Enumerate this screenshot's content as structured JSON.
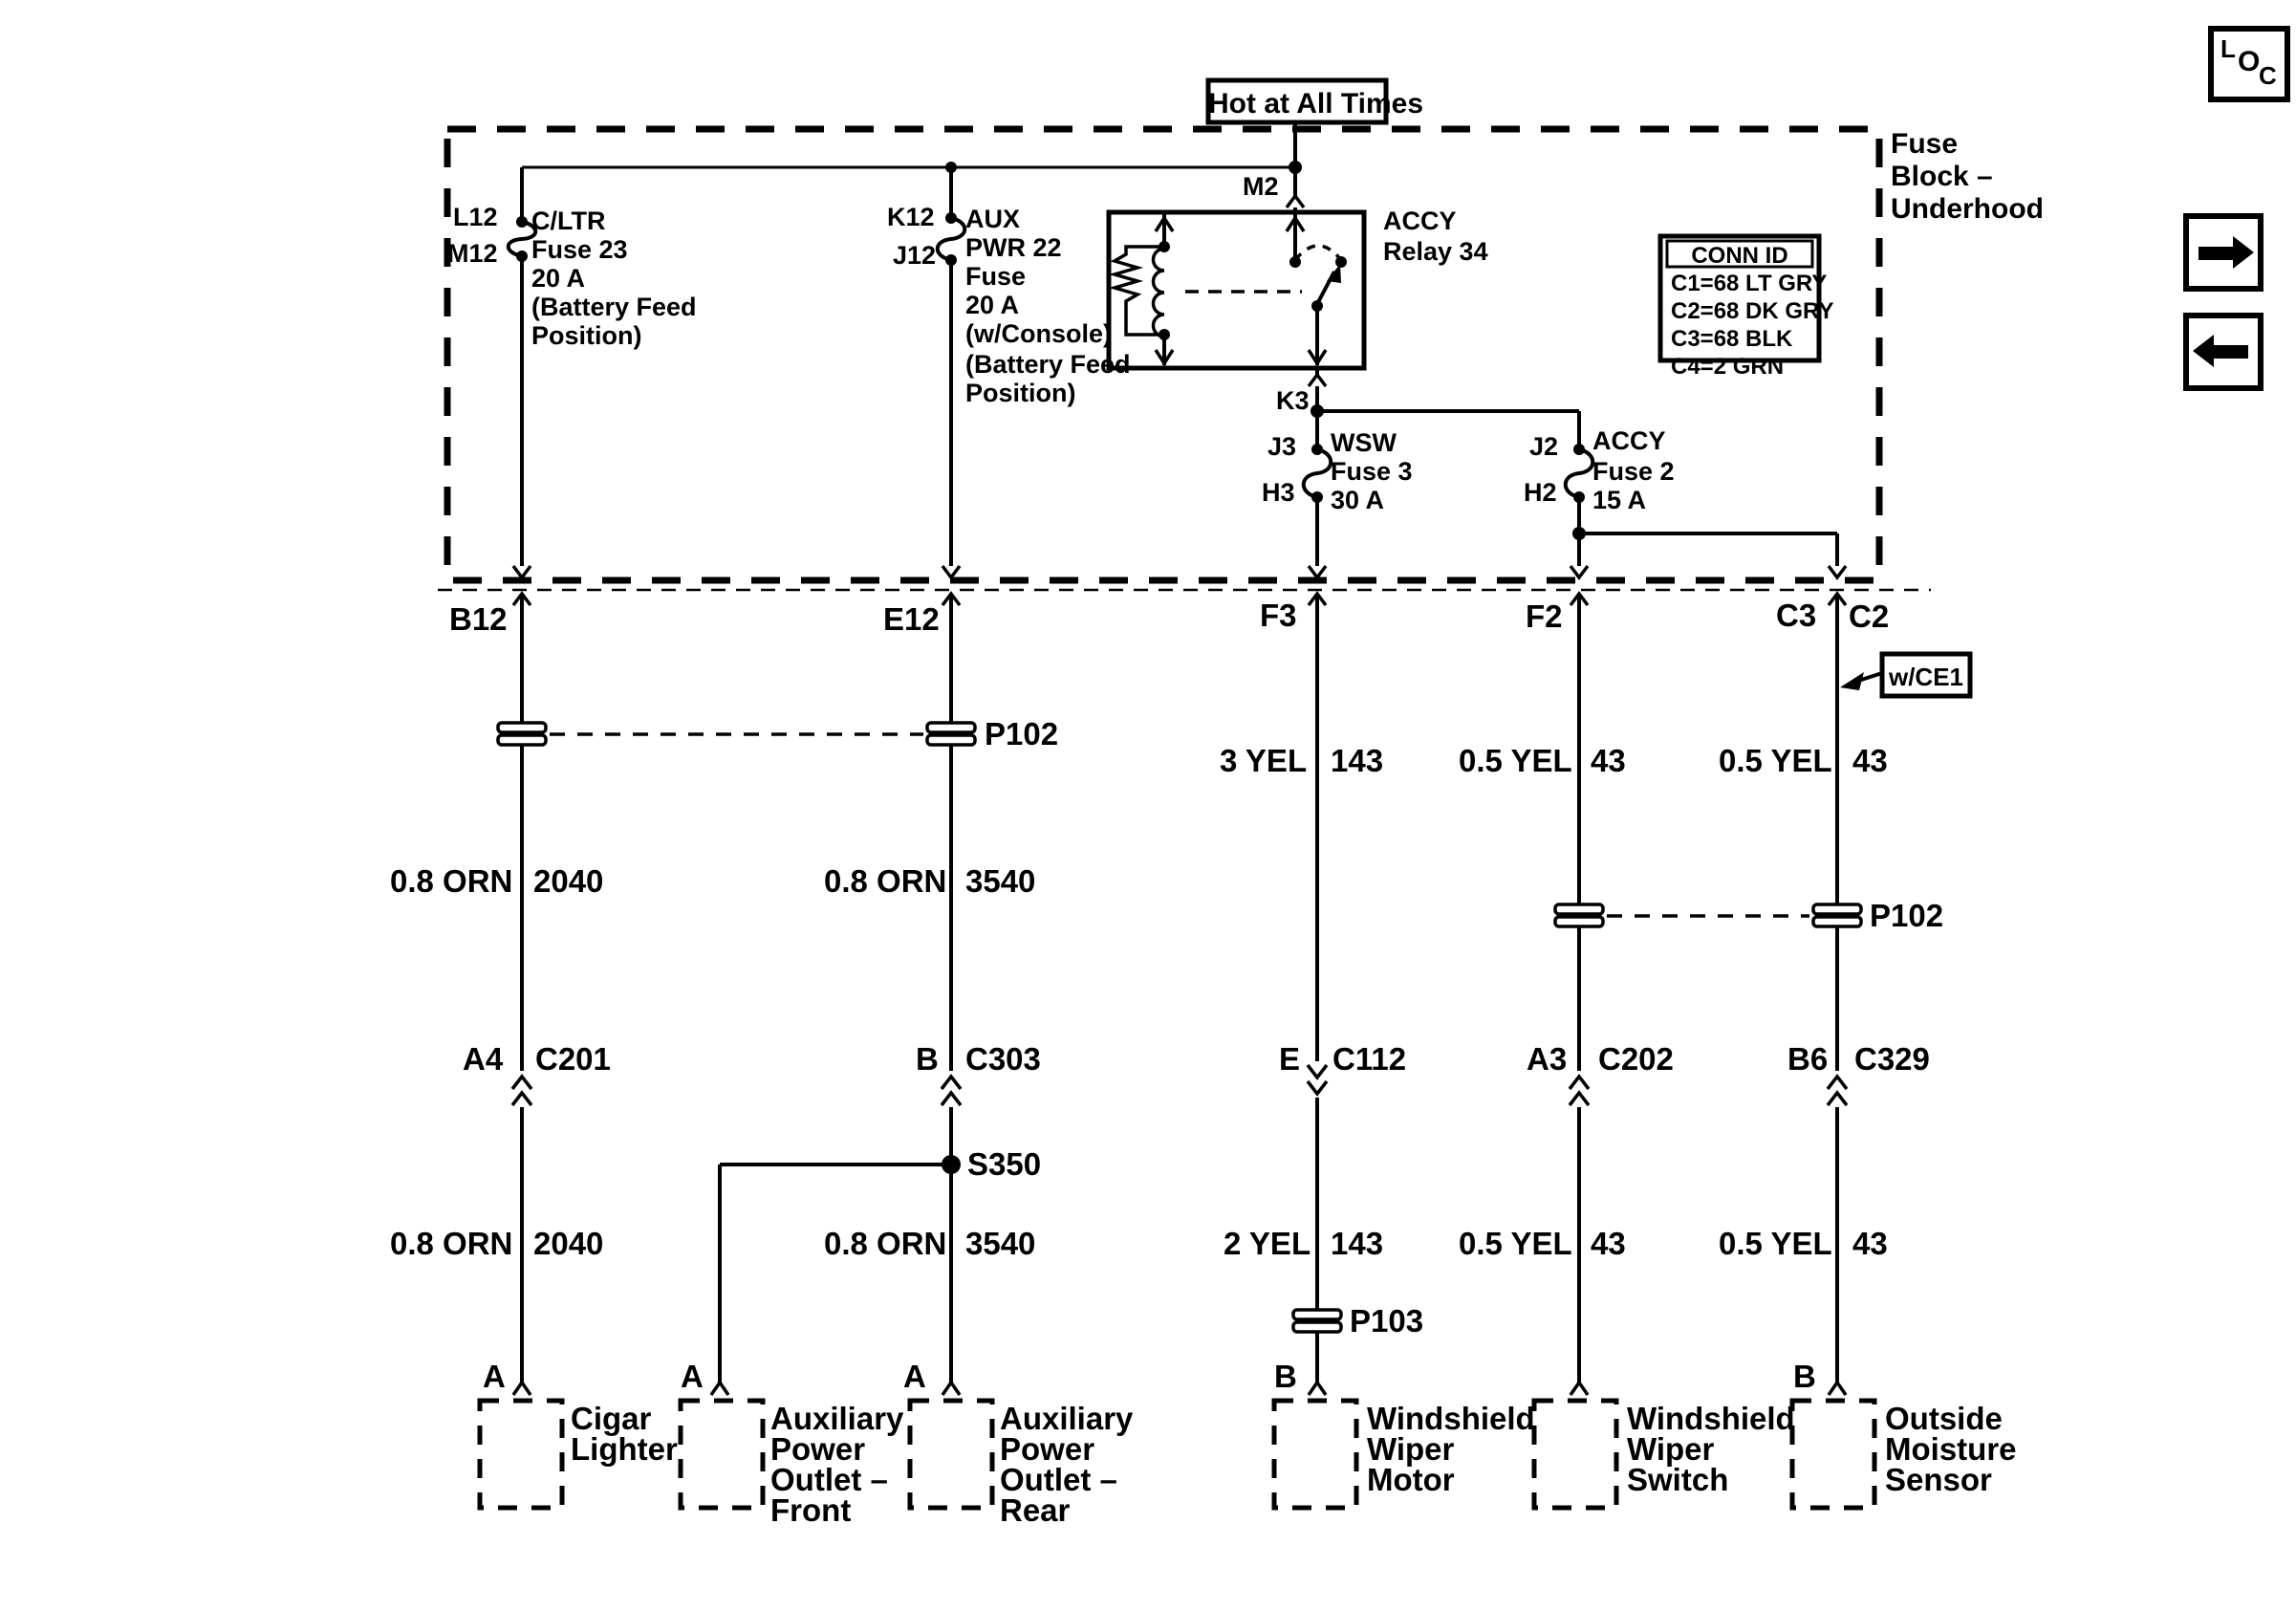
{
  "diagram": {
    "hot_label": "Hot at All Times",
    "block_name": [
      "Fuse",
      "Block –",
      "Underhood"
    ],
    "relay_label": [
      "ACCY",
      "Relay 34"
    ],
    "conn_id": {
      "title": "CONN ID",
      "rows": [
        "C1=68 LT GRY",
        "C2=68 DK GRY",
        "C3=68 BLK",
        "C4=2 GRN"
      ]
    },
    "terminals": {
      "m2": "M2",
      "k3": "K3",
      "l12": "L12",
      "m12": "M12",
      "k12": "K12",
      "j12": "J12",
      "j3": "J3",
      "h3": "H3",
      "j2": "J2",
      "h2": "H2"
    },
    "fuses": {
      "cltr": [
        "C/LTR",
        "Fuse 23",
        "20 A",
        "(Battery Feed",
        "Position)"
      ],
      "aux": [
        "AUX",
        "PWR 22",
        "Fuse",
        "20 A",
        "(w/Console)",
        "(Battery Feed",
        "Position)"
      ],
      "wsw": [
        "WSW",
        "Fuse 3",
        "30 A"
      ],
      "accy": [
        "ACCY",
        "Fuse 2",
        "15 A"
      ]
    },
    "block_exits": [
      "B12",
      "E12",
      "F3",
      "F2",
      "C3",
      "C2"
    ],
    "note_wce1": "w/CE1",
    "splices": {
      "s350": "S350"
    },
    "pass_throughs": {
      "p102_left": "P102",
      "p102_right": "P102",
      "p103": "P103"
    },
    "inline_connectors": [
      {
        "pin": "A4",
        "name": "C201"
      },
      {
        "pin": "B",
        "name": "C303"
      },
      {
        "pin": "E",
        "name": "C112"
      },
      {
        "pin": "A3",
        "name": "C202"
      },
      {
        "pin": "B6",
        "name": "C329"
      }
    ],
    "wire_labels": [
      {
        "gauge": "3 YEL",
        "circuit": "143"
      },
      {
        "gauge": "0.5 YEL",
        "circuit": "43"
      },
      {
        "gauge": "0.5 YEL",
        "circuit": "43"
      },
      {
        "gauge": "0.8 ORN",
        "circuit": "2040"
      },
      {
        "gauge": "0.8 ORN",
        "circuit": "3540"
      },
      {
        "gauge": "0.8 ORN",
        "circuit": "2040"
      },
      {
        "gauge": "0.8 ORN",
        "circuit": "3540"
      },
      {
        "gauge": "2 YEL",
        "circuit": "143"
      },
      {
        "gauge": "0.5 YEL",
        "circuit": "43"
      },
      {
        "gauge": "0.5 YEL",
        "circuit": "43"
      }
    ],
    "components": [
      {
        "pin": "A",
        "lines": [
          "Cigar",
          "Lighter"
        ]
      },
      {
        "pin": "A",
        "lines": [
          "Auxiliary",
          "Power",
          "Outlet –",
          "Front"
        ]
      },
      {
        "pin": "A",
        "lines": [
          "Auxiliary",
          "Power",
          "Outlet –",
          "Rear"
        ]
      },
      {
        "pin": "B",
        "lines": [
          "Windshield",
          "Wiper",
          "Motor"
        ]
      },
      {
        "pin": "",
        "lines": [
          "Windshield",
          "Wiper",
          "Switch"
        ]
      },
      {
        "pin": "B",
        "lines": [
          "Outside",
          "Moisture",
          "Sensor"
        ]
      }
    ],
    "nav": {
      "loc": [
        "L",
        "O",
        "C"
      ]
    }
  }
}
